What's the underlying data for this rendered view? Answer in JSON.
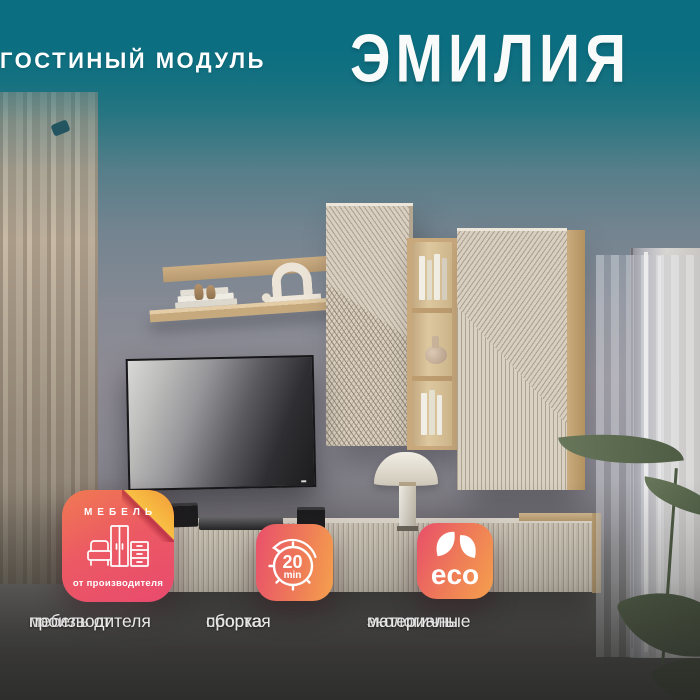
{
  "title": {
    "name": "ЭМИЛИЯ",
    "subtitle": "ГОСТИНЫЙ МОДУЛЬ"
  },
  "badges": {
    "manufacturer": {
      "icon": "furniture-outline-icon",
      "header": "МЕБЕЛЬ",
      "footer": "от производителя",
      "caption_line1": "мебель от",
      "caption_line2": "производителя"
    },
    "assembly": {
      "icon": "timer-20min-icon",
      "value": "20",
      "unit": "min",
      "caption_line1": "простая",
      "caption_line2": "сборка"
    },
    "eco": {
      "icon": "eco-leaves-icon",
      "label": "eco",
      "caption_line1": "экологичные",
      "caption_line2": "материалы"
    }
  },
  "colors": {
    "teal_top": "#0f7183",
    "badge_pink": "#e94a6e",
    "badge_orange": "#f5a04d",
    "fold_yellow": "#ffd94f",
    "title_text": "#ffffff",
    "caption_text": "#e9e9ea"
  }
}
